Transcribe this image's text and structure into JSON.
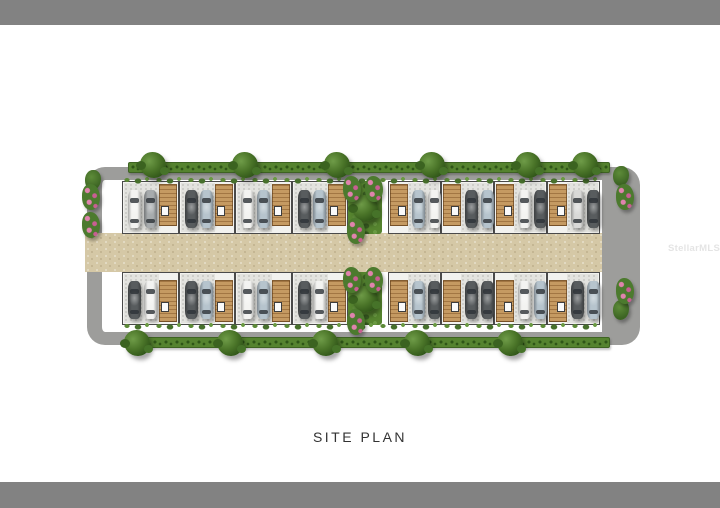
{
  "page": {
    "caption": "SITE PLAN",
    "watermark": "StellarMLS"
  },
  "colors": {
    "border_bar": "#828282",
    "page_bg": "#ffffff",
    "road": "#d5c8a6",
    "perimeter_path": "#9d9d9b",
    "hedge_green": "#55832f",
    "tree_green": "#3c6526",
    "driveway_concrete": "#e3e3df",
    "patio_wood": "#c59a62",
    "flower_pink": "#d96a9a",
    "car_palette": {
      "white": "#f3f3f1",
      "silver": "#d9d9d7",
      "gray": "#a7abad",
      "dark-gray": "#585c5e",
      "light-blue": "#b6c4cd"
    }
  },
  "site_plan": {
    "type": "townhome-community-site-plan",
    "unit_count": 16,
    "units_per_row": 8,
    "rows": [
      {
        "side": "north",
        "units": [
          {
            "group": "west",
            "patio": "right",
            "cars": [
              "white",
              "gray"
            ]
          },
          {
            "group": "west",
            "patio": "right",
            "cars": [
              "dark-gray",
              "light-blue"
            ]
          },
          {
            "group": "west",
            "patio": "right",
            "cars": [
              "white",
              "light-blue"
            ]
          },
          {
            "group": "west",
            "patio": "right",
            "cars": [
              "dark-gray",
              "light-blue"
            ]
          },
          {
            "group": "east",
            "patio": "left",
            "cars": [
              "light-blue",
              "white"
            ]
          },
          {
            "group": "east",
            "patio": "left",
            "cars": [
              "dark-gray",
              "light-blue"
            ]
          },
          {
            "group": "east",
            "patio": "left",
            "cars": [
              "white",
              "dark-gray"
            ]
          },
          {
            "group": "east",
            "patio": "left",
            "cars": [
              "silver",
              "dark-gray"
            ]
          }
        ]
      },
      {
        "side": "south",
        "units": [
          {
            "group": "west",
            "patio": "right",
            "cars": [
              "dark-gray",
              "white"
            ]
          },
          {
            "group": "west",
            "patio": "right",
            "cars": [
              "dark-gray",
              "light-blue"
            ]
          },
          {
            "group": "west",
            "patio": "right",
            "cars": [
              "white",
              "light-blue"
            ]
          },
          {
            "group": "west",
            "patio": "right",
            "cars": [
              "dark-gray",
              "white"
            ]
          },
          {
            "group": "east",
            "patio": "left",
            "cars": [
              "light-blue",
              "dark-gray"
            ]
          },
          {
            "group": "east",
            "patio": "left",
            "cars": [
              "dark-gray",
              "dark-gray"
            ]
          },
          {
            "group": "east",
            "patio": "left",
            "cars": [
              "white",
              "light-blue"
            ]
          },
          {
            "group": "east",
            "patio": "left",
            "cars": [
              "dark-gray",
              "light-blue"
            ]
          }
        ]
      }
    ],
    "road_vehicles": [
      {
        "color": "white",
        "x": 45,
        "y": 90,
        "heading": "west"
      },
      {
        "color": "gray",
        "x": 368,
        "y": 107,
        "heading": "west"
      }
    ],
    "landscaping": {
      "trees_top_x": [
        68,
        160,
        252,
        347,
        443,
        500
      ],
      "trees_bottom_x": [
        52,
        145,
        240,
        332,
        425
      ],
      "flowers": [
        {
          "x": -3,
          "y": 36
        },
        {
          "x": -3,
          "y": 64
        },
        {
          "x": 531,
          "y": 36
        },
        {
          "x": 531,
          "y": 130
        },
        {
          "x": 258,
          "y": 28
        },
        {
          "x": 280,
          "y": 28
        },
        {
          "x": 262,
          "y": 70
        },
        {
          "x": 258,
          "y": 119
        },
        {
          "x": 280,
          "y": 119
        },
        {
          "x": 262,
          "y": 161
        }
      ],
      "bushes": [
        {
          "x": 528,
          "y": 18
        },
        {
          "x": 528,
          "y": 152
        },
        {
          "x": 0,
          "y": 22
        }
      ]
    }
  }
}
